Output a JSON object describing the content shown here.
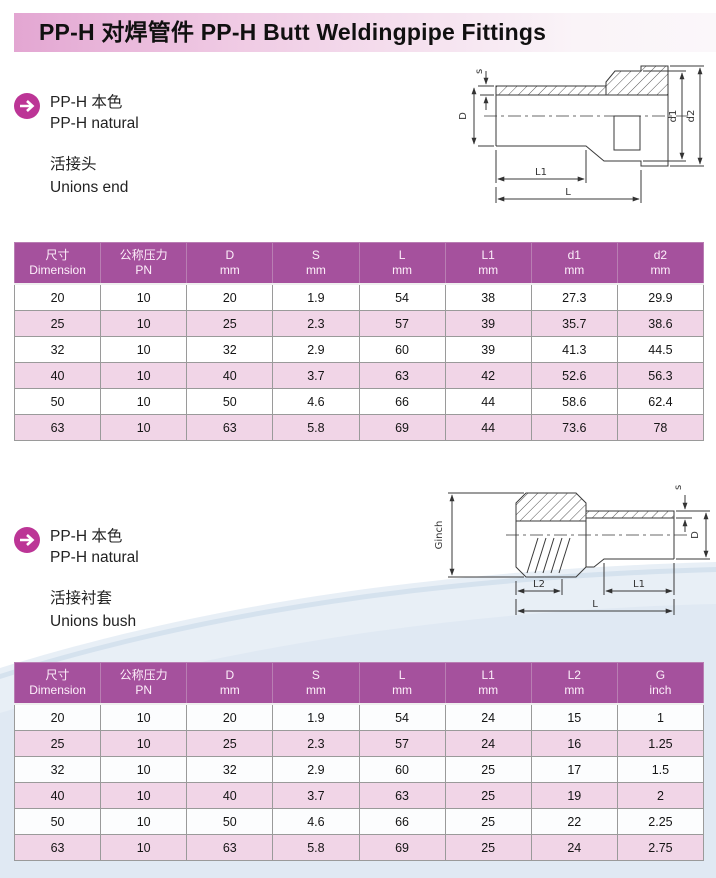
{
  "header": {
    "title": "PP-H  对焊管件 PP-H Butt Weldingpipe Fittings"
  },
  "icons": {
    "section_bullet": "arrow-right-circle"
  },
  "colors": {
    "header_purple": "#a5519d",
    "row_pink": "#f1d5e7",
    "accent_circle": "#bc3596",
    "banner_left": "#e3a6d2",
    "banner_right": "#faf4f8",
    "wave_blue": "#d8e4f0"
  },
  "sections": [
    {
      "material_cn": "PP-H 本色",
      "material_en": "PP-H natural",
      "product_cn": "活接头",
      "product_en": "Unions end",
      "drawing": {
        "labels": {
          "s": "s",
          "D": "D",
          "d1": "d1",
          "d2": "d2",
          "L1": "L1",
          "L": "L"
        }
      },
      "table": {
        "headers": [
          {
            "top": "尺寸",
            "bottom": "Dimension"
          },
          {
            "top": "公称压力",
            "bottom": "PN"
          },
          {
            "top": "D",
            "bottom": "mm"
          },
          {
            "top": "S",
            "bottom": "mm"
          },
          {
            "top": "L",
            "bottom": "mm"
          },
          {
            "top": "L1",
            "bottom": "mm"
          },
          {
            "top": "d1",
            "bottom": "mm"
          },
          {
            "top": "d2",
            "bottom": "mm"
          }
        ],
        "rows": [
          [
            "20",
            "10",
            "20",
            "1.9",
            "54",
            "38",
            "27.3",
            "29.9"
          ],
          [
            "25",
            "10",
            "25",
            "2.3",
            "57",
            "39",
            "35.7",
            "38.6"
          ],
          [
            "32",
            "10",
            "32",
            "2.9",
            "60",
            "39",
            "41.3",
            "44.5"
          ],
          [
            "40",
            "10",
            "40",
            "3.7",
            "63",
            "42",
            "52.6",
            "56.3"
          ],
          [
            "50",
            "10",
            "50",
            "4.6",
            "66",
            "44",
            "58.6",
            "62.4"
          ],
          [
            "63",
            "10",
            "63",
            "5.8",
            "69",
            "44",
            "73.6",
            "78"
          ]
        ]
      }
    },
    {
      "material_cn": "PP-H 本色",
      "material_en": "PP-H natural",
      "product_cn": "活接衬套",
      "product_en": "Unions bush",
      "drawing": {
        "labels": {
          "Ginch": "Ginch",
          "s": "s",
          "D": "D",
          "L2": "L2",
          "L1": "L1",
          "L": "L"
        }
      },
      "table": {
        "headers": [
          {
            "top": "尺寸",
            "bottom": "Dimension"
          },
          {
            "top": "公称压力",
            "bottom": "PN"
          },
          {
            "top": "D",
            "bottom": "mm"
          },
          {
            "top": "S",
            "bottom": "mm"
          },
          {
            "top": "L",
            "bottom": "mm"
          },
          {
            "top": "L1",
            "bottom": "mm"
          },
          {
            "top": "L2",
            "bottom": "mm"
          },
          {
            "top": "G",
            "bottom": "inch"
          }
        ],
        "rows": [
          [
            "20",
            "10",
            "20",
            "1.9",
            "54",
            "24",
            "15",
            "1"
          ],
          [
            "25",
            "10",
            "25",
            "2.3",
            "57",
            "24",
            "16",
            "1.25"
          ],
          [
            "32",
            "10",
            "32",
            "2.9",
            "60",
            "25",
            "17",
            "1.5"
          ],
          [
            "40",
            "10",
            "40",
            "3.7",
            "63",
            "25",
            "19",
            "2"
          ],
          [
            "50",
            "10",
            "50",
            "4.6",
            "66",
            "25",
            "22",
            "2.25"
          ],
          [
            "63",
            "10",
            "63",
            "5.8",
            "69",
            "25",
            "24",
            "2.75"
          ]
        ]
      }
    }
  ]
}
